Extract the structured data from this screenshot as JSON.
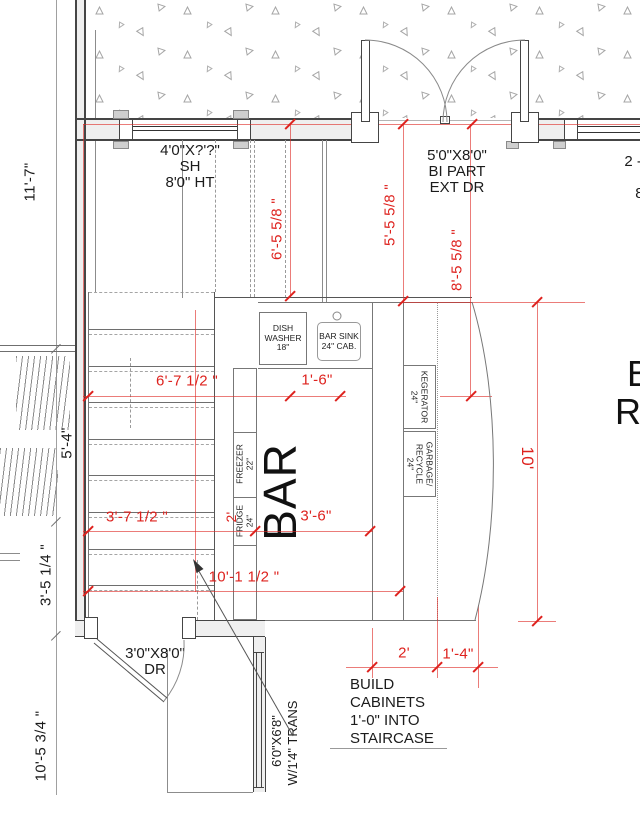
{
  "colors": {
    "dimension_red": "#de221e",
    "line_gray": "#8c8c8c",
    "wall_dark": "#454545",
    "text_black": "#1b1b1b"
  },
  "labels": {
    "window_top_left": {
      "line1": "4'0\"X?'?\"",
      "line2": "SH",
      "line3": "8'0\" HT"
    },
    "door_bipart": {
      "line1": "5'0\"X8'0\"",
      "line2": "BI PART",
      "line3": "EXT DR"
    },
    "window_top_right_clipped": {
      "line1": "2 - 2'0",
      "line2": "S",
      "line3": "8'0"
    },
    "appliances": {
      "dishwasher": {
        "line1": "DISH",
        "line2": "WASHER",
        "line3": "18\""
      },
      "bar_sink": {
        "line1": "BAR SINK",
        "line2": "24\" CAB."
      },
      "kegerator": {
        "line1": "KEGERATOR",
        "line2": "24\""
      },
      "garbage": {
        "line1": "GARBAGE/",
        "line2": "RECYCLE",
        "line3": "24\""
      },
      "freezer": {
        "line1": "FREEZER",
        "line2": "22\""
      },
      "fridge": {
        "line1": "FRIDGE",
        "line2": "24\""
      }
    },
    "bar": "BAR",
    "room_right_clipped": {
      "line1": "B",
      "line2": "R"
    },
    "door_bottom": {
      "line1": "3'0\"X8'0\"",
      "line2": "DR"
    },
    "window_bottom": {
      "line1": "6'0\"X6'8\"",
      "line2": "W/1'4\" TRANS"
    },
    "note": {
      "line1": "BUILD",
      "line2": "CABINETS",
      "line3": "1'-0\" INTO",
      "line4": "STAIRCASE"
    }
  },
  "dimensions": {
    "black": {
      "upper_left": "11'-7\"",
      "stair_width": "5'-4\"",
      "mid_left": "3'-5 1/4 \"",
      "lower_left": "10'-5 3/4 \""
    },
    "red": {
      "shelf_run": "6'-5 5/8 \"",
      "door_offset_left": "5'-5 5/8 \"",
      "door_offset_right": "8'-5 5/8 \"",
      "upper_run": "6'-7 1/2 \"",
      "sink_run": "1'-6\"",
      "lower_run": "3'-7 1/2 \"",
      "fridge_depth": "2'",
      "bar_open": "3'-6\"",
      "overall_run": "10'-1 1/2 \"",
      "bar_length": "10'",
      "cab_width": "2'",
      "cab_bump": "1'-4\""
    }
  }
}
